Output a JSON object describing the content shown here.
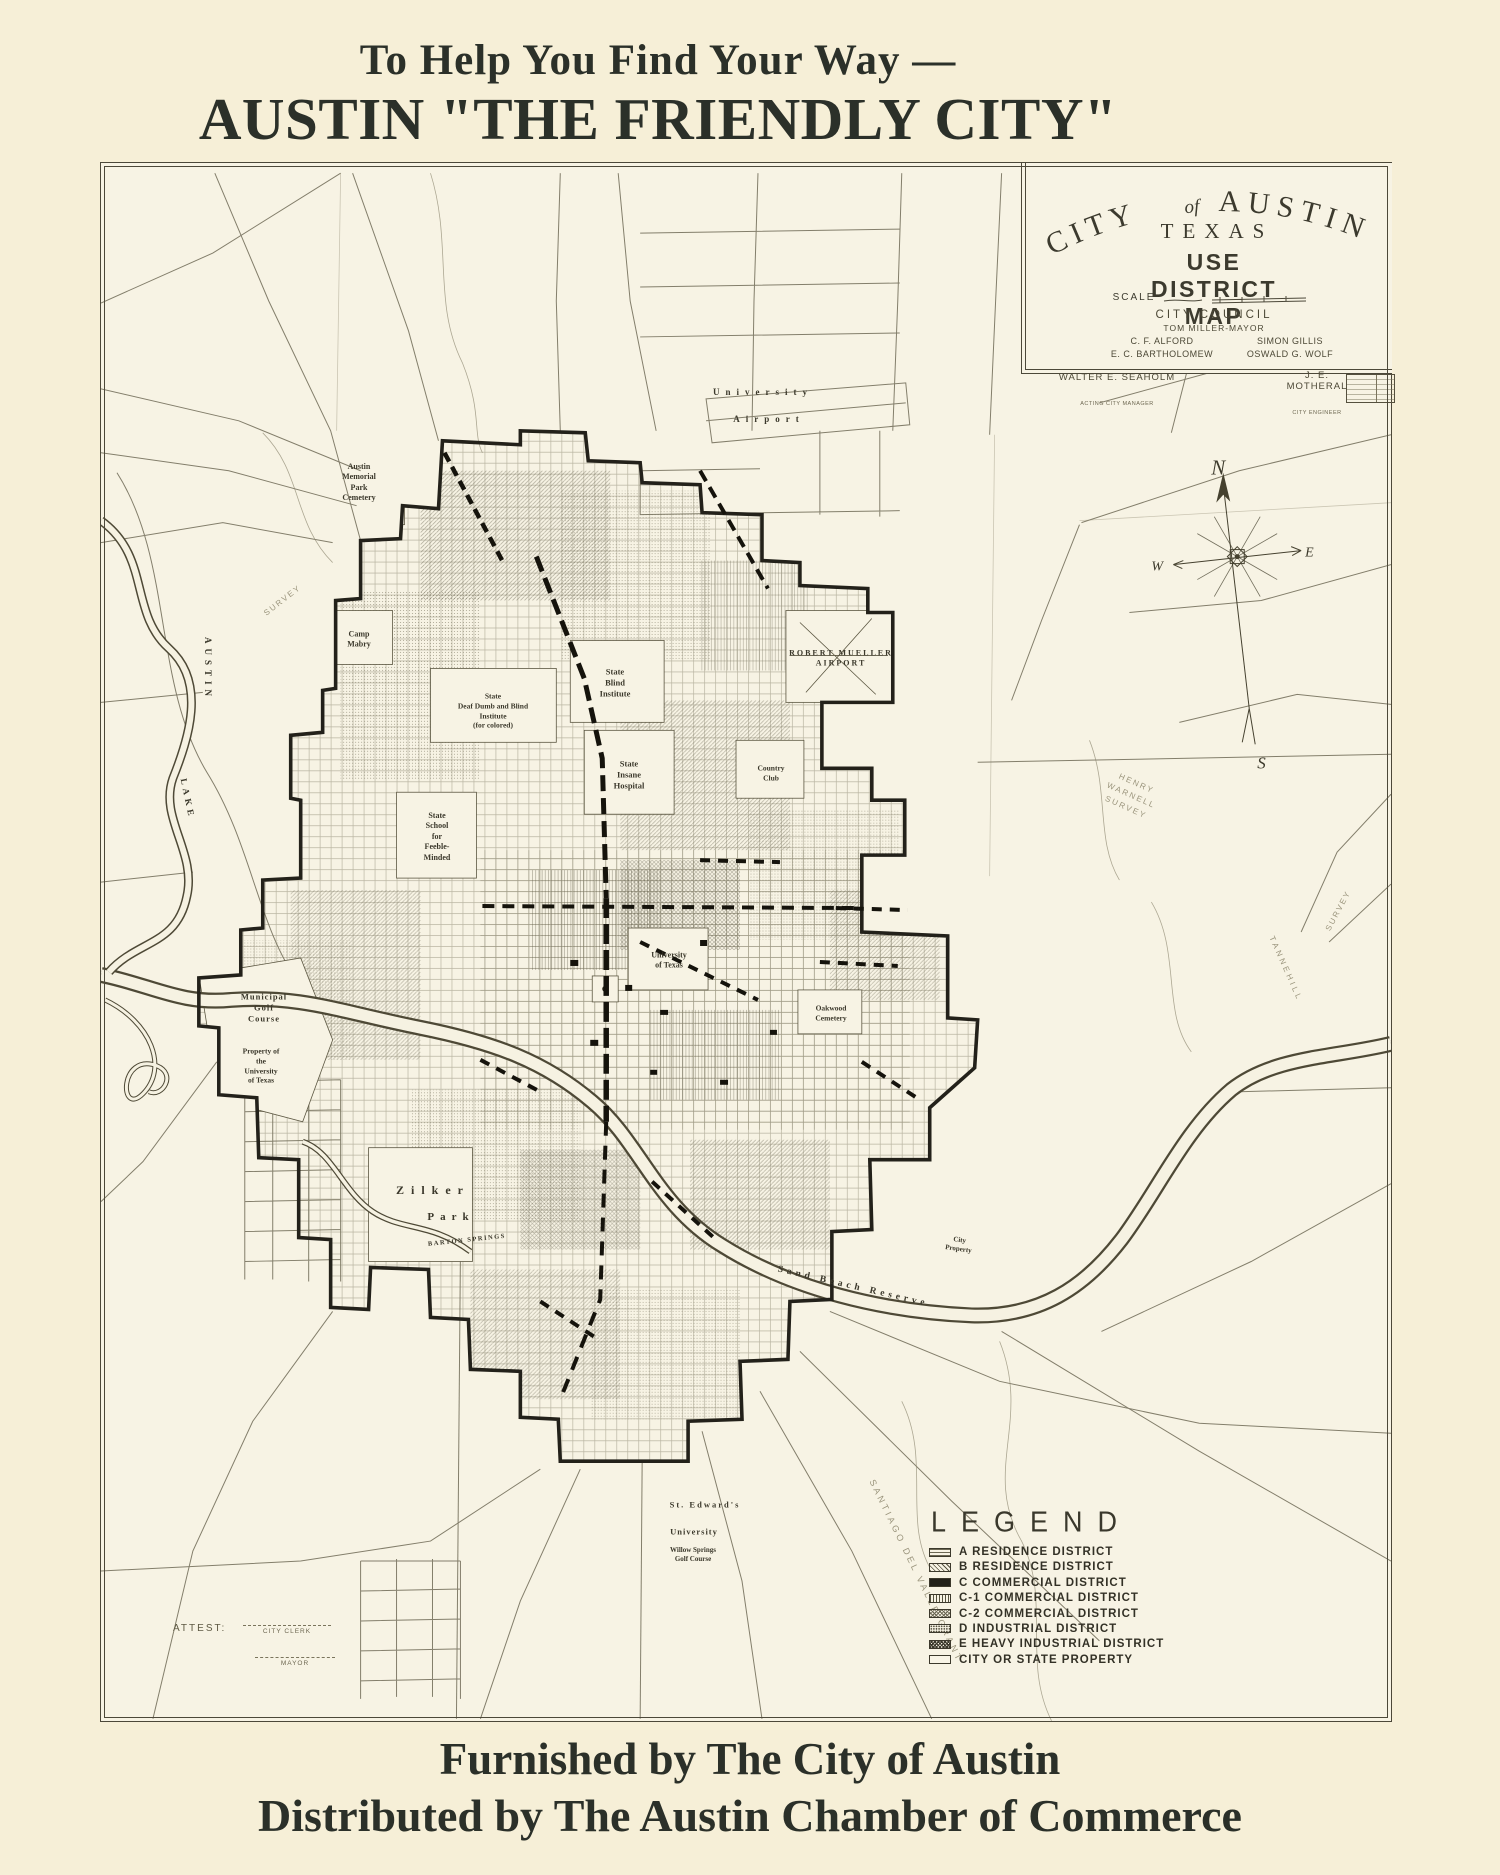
{
  "header": {
    "line1": "To Help You Find Your Way —",
    "line2": "AUSTIN \"THE FRIENDLY CITY\""
  },
  "footer": {
    "line1": "Furnished by The City of Austin",
    "line2": "Distributed by The Austin Chamber of Commerce"
  },
  "cartouche": {
    "title_city": "CITY",
    "title_of": "of",
    "title_austin": "AUSTIN",
    "state": "TEXAS",
    "subtitle": "USE DISTRICT MAP",
    "scale_label": "SCALE",
    "council_heading": "CITY COUNCIL",
    "mayor_line": "TOM MILLER-MAYOR",
    "council_left": "C. F. ALFORD\nE. C. BARTHOLOMEW",
    "council_right": "SIMON GILLIS\nOSWALD G. WOLF",
    "manager_name": "WALTER E. SEAHOLM",
    "manager_title": "ACTING CITY MANAGER",
    "engineer_name": "J. E. MOTHERAL",
    "engineer_title": "CITY ENGINEER"
  },
  "compass": {
    "n": "N",
    "e": "E",
    "s": "S",
    "w": "W"
  },
  "legend": {
    "title": "LEGEND",
    "items": [
      {
        "label": "A RESIDENCE DISTRICT",
        "swatch": "horizontal-lines"
      },
      {
        "label": "B RESIDENCE DISTRICT",
        "swatch": "diagonal-hatch"
      },
      {
        "label": "C COMMERCIAL DISTRICT",
        "swatch": "solid-black"
      },
      {
        "label": "C-1 COMMERCIAL DISTRICT",
        "swatch": "vertical-lines"
      },
      {
        "label": "C-2 COMMERCIAL DISTRICT",
        "swatch": "fine-crosshatch"
      },
      {
        "label": "D INDUSTRIAL DISTRICT",
        "swatch": "stipple"
      },
      {
        "label": "E HEAVY INDUSTRIAL DISTRICT",
        "swatch": "dense-crosshatch"
      },
      {
        "label": "CITY OR STATE PROPERTY",
        "swatch": "blank"
      }
    ]
  },
  "attest": {
    "label": "ATTEST:",
    "clerk": "CITY CLERK",
    "mayor": "MAYOR"
  },
  "map_labels": [
    {
      "text": "University"
    },
    {
      "text": "Airport"
    },
    {
      "text": "Austin\nMemorial\nPark\nCemetery"
    },
    {
      "text": "Camp\nMabry"
    },
    {
      "text": "State\nBlind\nInstitute"
    },
    {
      "text": "State\nDeaf Dumb and Blind\nInstitute\n(for colored)"
    },
    {
      "text": "State\nInsane\nHospital"
    },
    {
      "text": "State\nSchool\nfor\nFeeble-\nMinded"
    },
    {
      "text": "ROBERT MUELLER\nAIRPORT"
    },
    {
      "text": "Country\nClub"
    },
    {
      "text": "University\nof Texas"
    },
    {
      "text": "Oakwood\nCemetery"
    },
    {
      "text": "Municipal\nGolf\nCourse"
    },
    {
      "text": "Property of\nthe\nUniversity\nof Texas"
    },
    {
      "text": "AUSTIN"
    },
    {
      "text": "LAKE"
    },
    {
      "text": "Zilker"
    },
    {
      "text": "Park"
    },
    {
      "text": "BARTON SPRINGS"
    },
    {
      "text": "Sand Beach Reserve"
    },
    {
      "text": "City\nProperty"
    },
    {
      "text": "St. Edward's"
    },
    {
      "text": "University"
    },
    {
      "text": "Willow Springs\nGolf Course"
    },
    {
      "text": "HENRY\nWARNELL\nSURVEY"
    },
    {
      "text": "TANNEHILL"
    },
    {
      "text": "SANTIAGO DEL VALLE GRANT"
    },
    {
      "text": "SURVEY"
    },
    {
      "text": "SURVEY"
    }
  ],
  "colors": {
    "paper": "#f6efd7",
    "map_paper": "#f7f3e4",
    "ink": "#2b3029",
    "line_ink": "#6f6a56",
    "heavy_ink": "#15130c"
  }
}
